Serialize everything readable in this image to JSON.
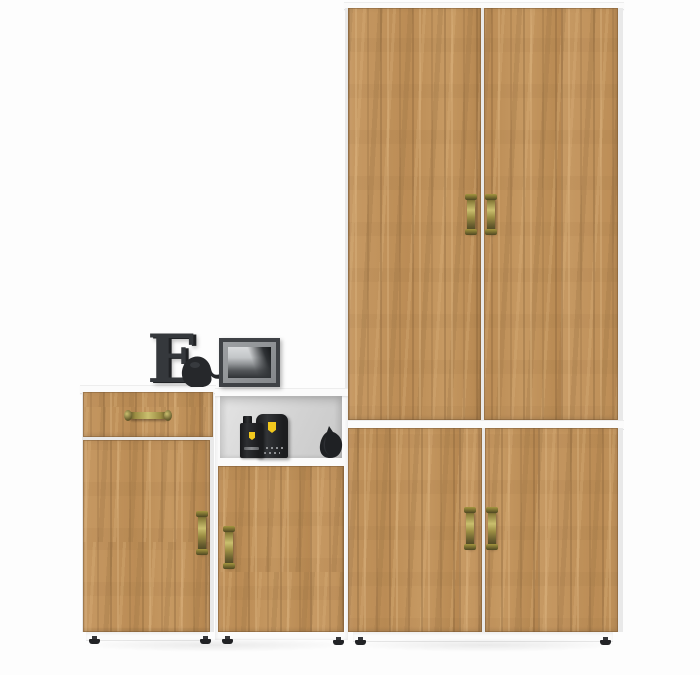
{
  "scene": {
    "type": "furniture-product-photo",
    "set_name": "hallway-storage-set-golden-oak-white",
    "objects": [
      {
        "name": "tall-wardrobe",
        "doors": 2,
        "handles": "antique-brass-vertical"
      },
      {
        "name": "low-two-door-cabinet",
        "doors": 2,
        "handles": "antique-brass-vertical"
      },
      {
        "name": "drawer-chest",
        "drawers": 1,
        "doors": 1
      },
      {
        "name": "open-shelf-cabinet",
        "doors": 1,
        "open_niche": true
      }
    ]
  },
  "decor": {
    "letter_text": "E",
    "items": [
      {
        "name": "decorative-letter",
        "text": "E",
        "color": "#35383c"
      },
      {
        "name": "bird-figurine",
        "color": "#2a2c2f"
      },
      {
        "name": "photo-frame",
        "photo": "black-and-white-landscape"
      },
      {
        "name": "perfume-bottle",
        "brand_logo": "yellow-shield"
      },
      {
        "name": "perfume-box",
        "brand_logo": "yellow-shield"
      },
      {
        "name": "cat-figurine",
        "color": "#232528"
      }
    ]
  },
  "palette": {
    "background": "#fdfdfd",
    "frame-white": "#fbfbfb",
    "wood-mid": "#c2945e",
    "wood-light": "#d8b07c",
    "wood-dark": "#9c7344",
    "niche-back": "#d2d2d2",
    "brass-light": "#cabf6e",
    "brass-dark": "#4f4722",
    "decor-dark": "#35383c",
    "black-item": "#222326",
    "ferrari-yellow": "#f2c81d"
  }
}
